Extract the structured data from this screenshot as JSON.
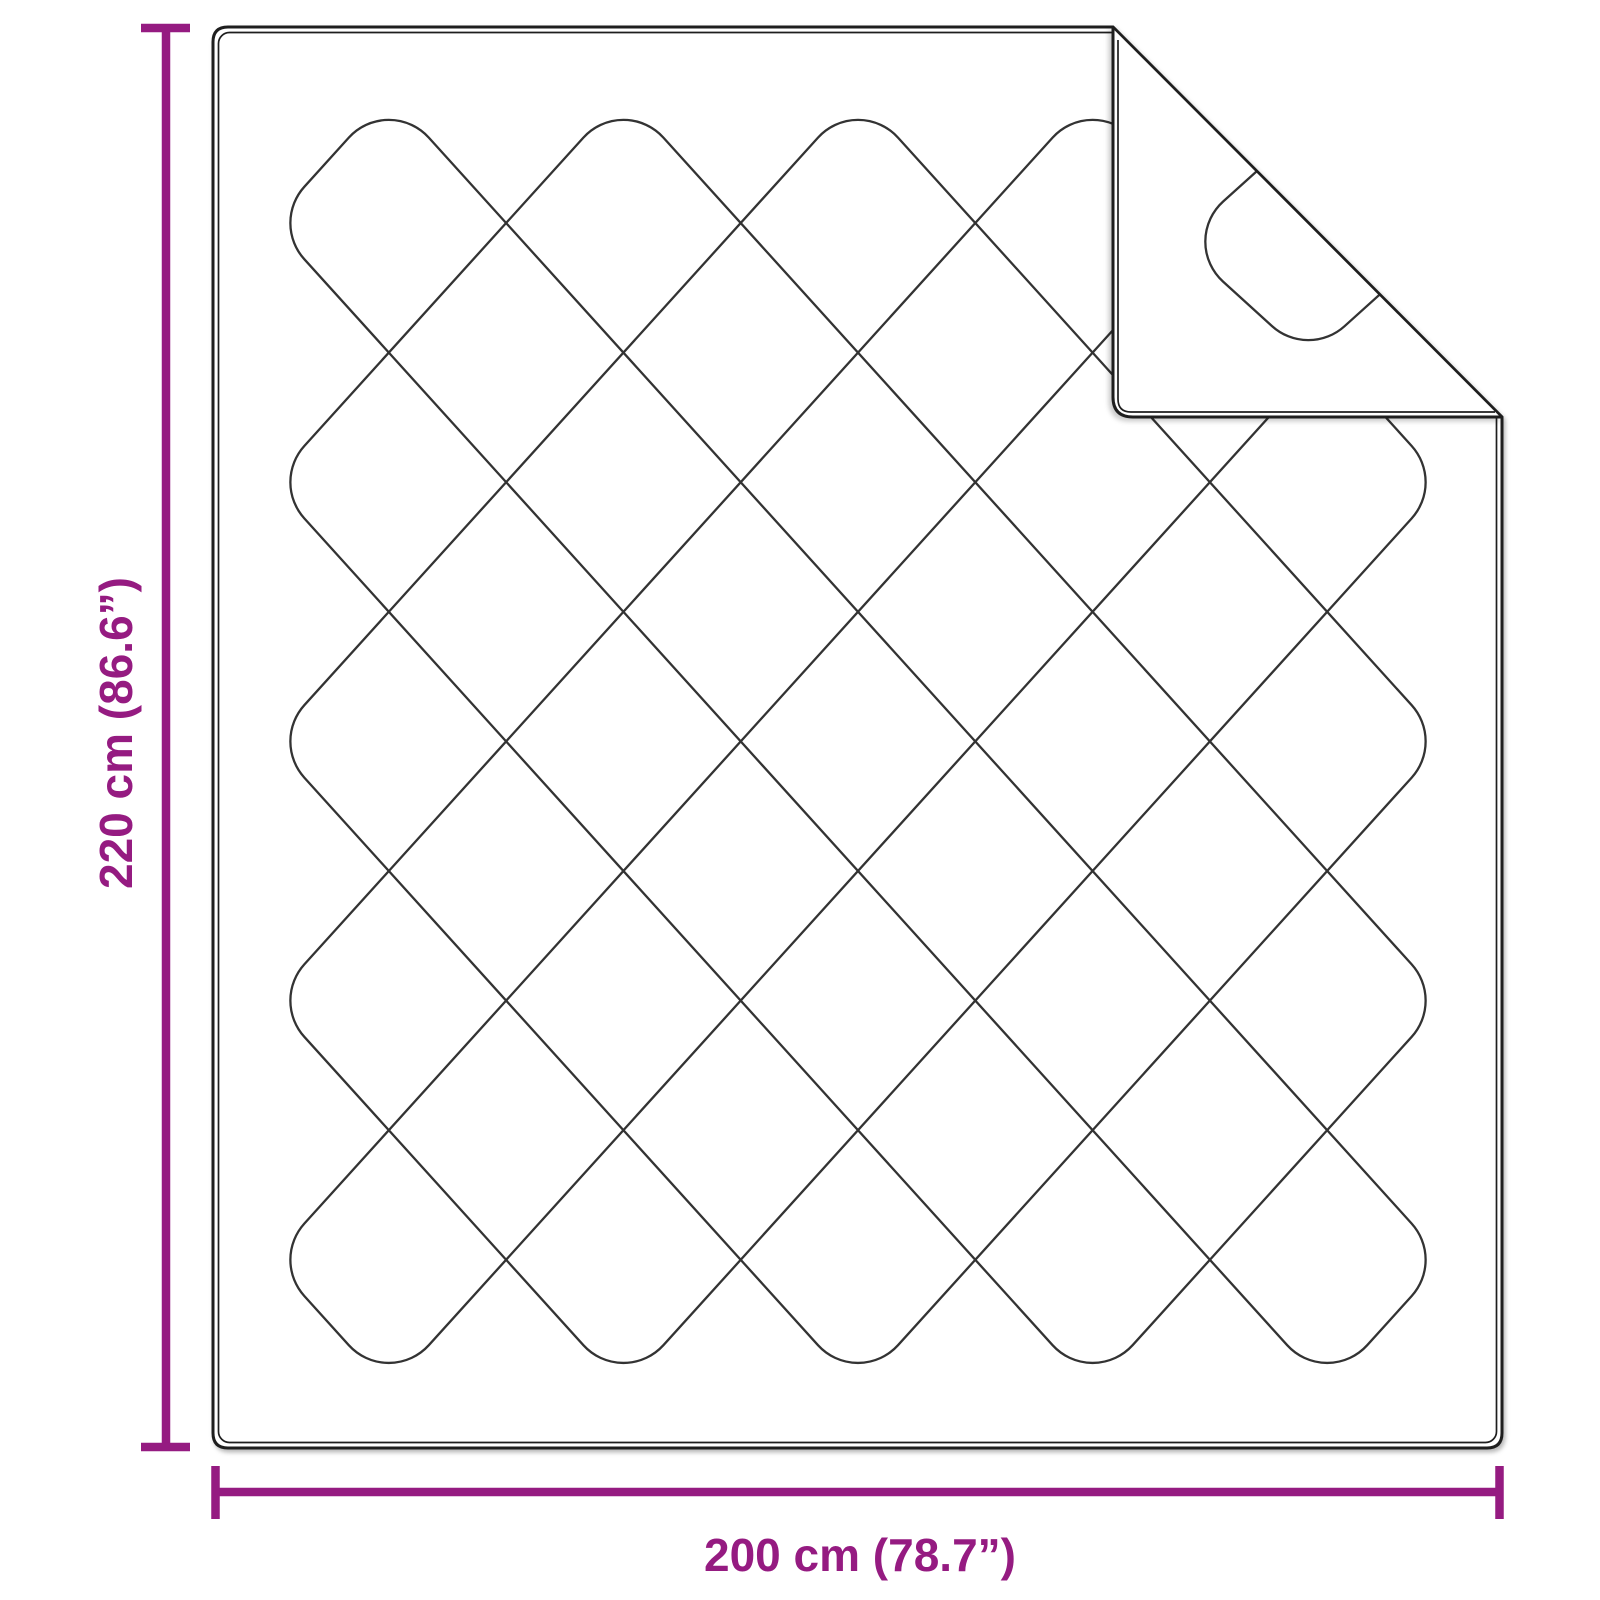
{
  "diagram": {
    "height_label": "220 cm (86.6”)",
    "width_label": "200 cm (78.7”)",
    "accent_color": "#951B81",
    "quilt_line_color": "#333333",
    "outline_color": "#1E1E1E",
    "background_color": "#FFFFFF"
  }
}
